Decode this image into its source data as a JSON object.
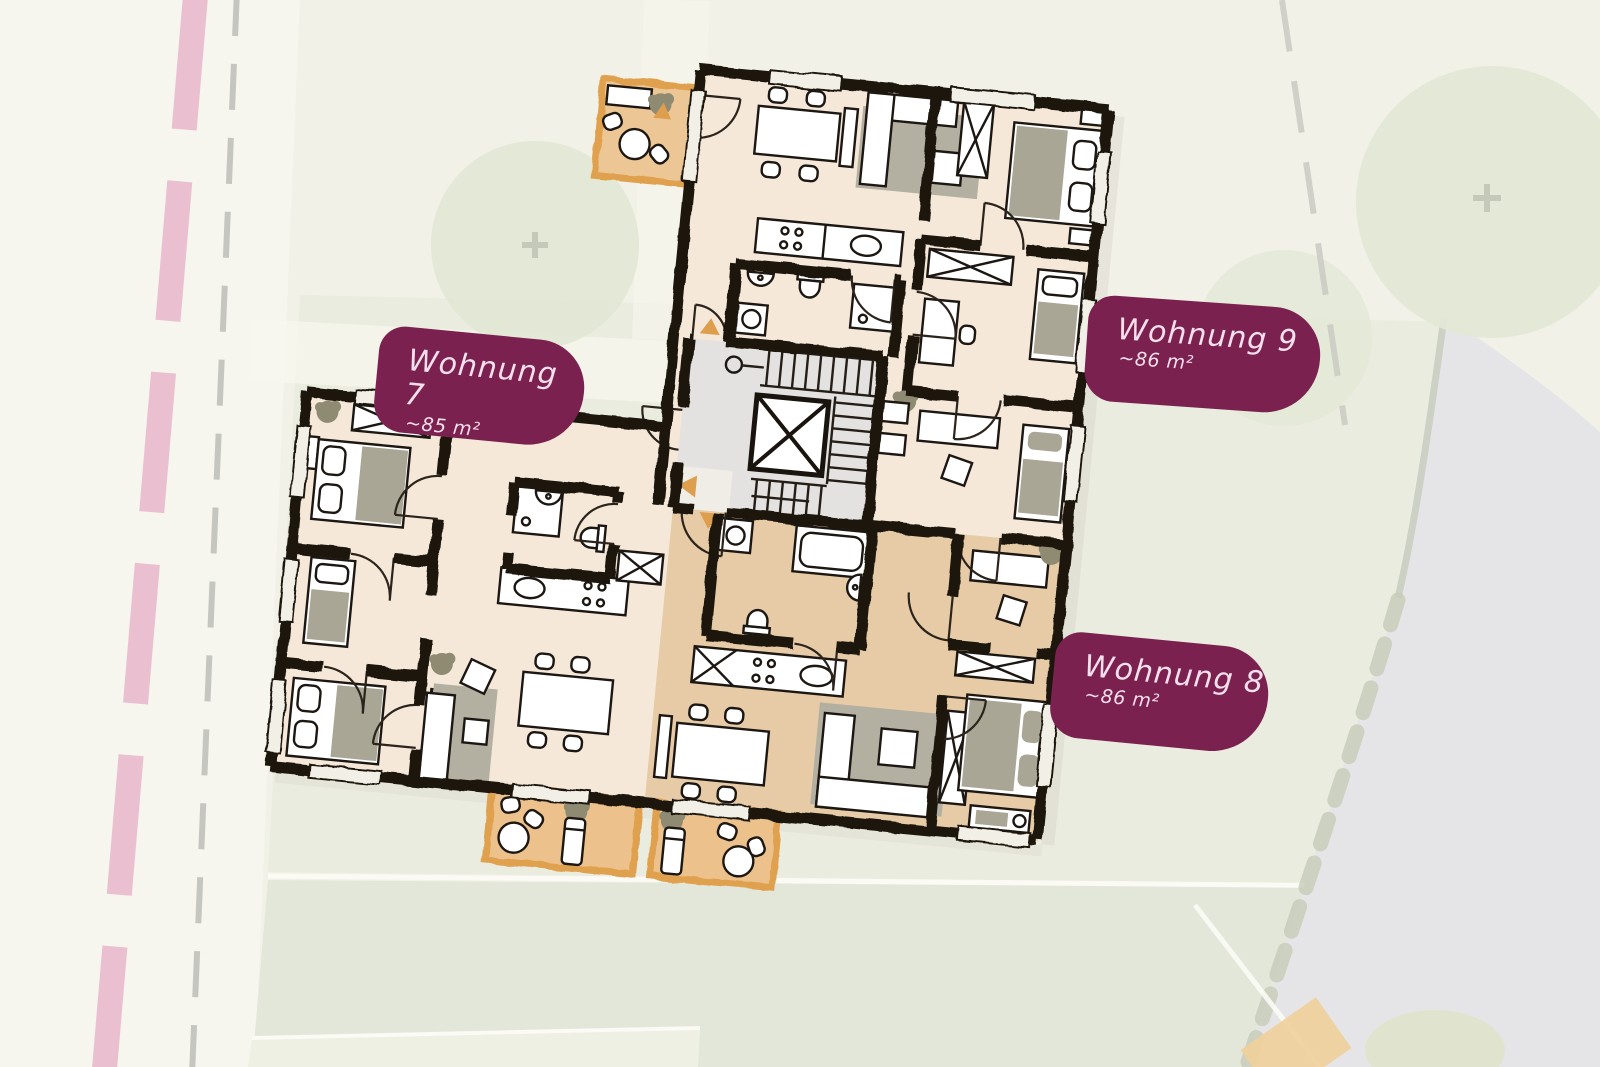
{
  "page": {
    "type": "apartment-floor-plan-site-map",
    "language": "de"
  },
  "apartments": [
    {
      "id": "wohnung-7",
      "label": "Wohnung 7",
      "area": "~85 m²"
    },
    {
      "id": "wohnung-9",
      "label": "Wohnung 9",
      "area": "~86 m²"
    },
    {
      "id": "wohnung-8",
      "label": "Wohnung 8",
      "area": "~86 m²"
    }
  ],
  "colors": {
    "badge_background": "#7b2150",
    "badge_text": "#f4dfeb",
    "wall": "#1a140e",
    "floor_cream": "#f5e8d9",
    "floor_tan": "#e6cba6",
    "stairwell": "#e4e2e0",
    "balcony_fill": "#ecc795",
    "balcony_border": "#e0a14f",
    "entry_arrow": "#dd9e4e",
    "lawn": "#e9ecde",
    "tree": "#e3e8d5",
    "boundary_pink": "#eabfd0",
    "boundary_gray": "#c6c6c0",
    "road": "#e5e5e7",
    "furniture_gray": "#a9a695"
  }
}
